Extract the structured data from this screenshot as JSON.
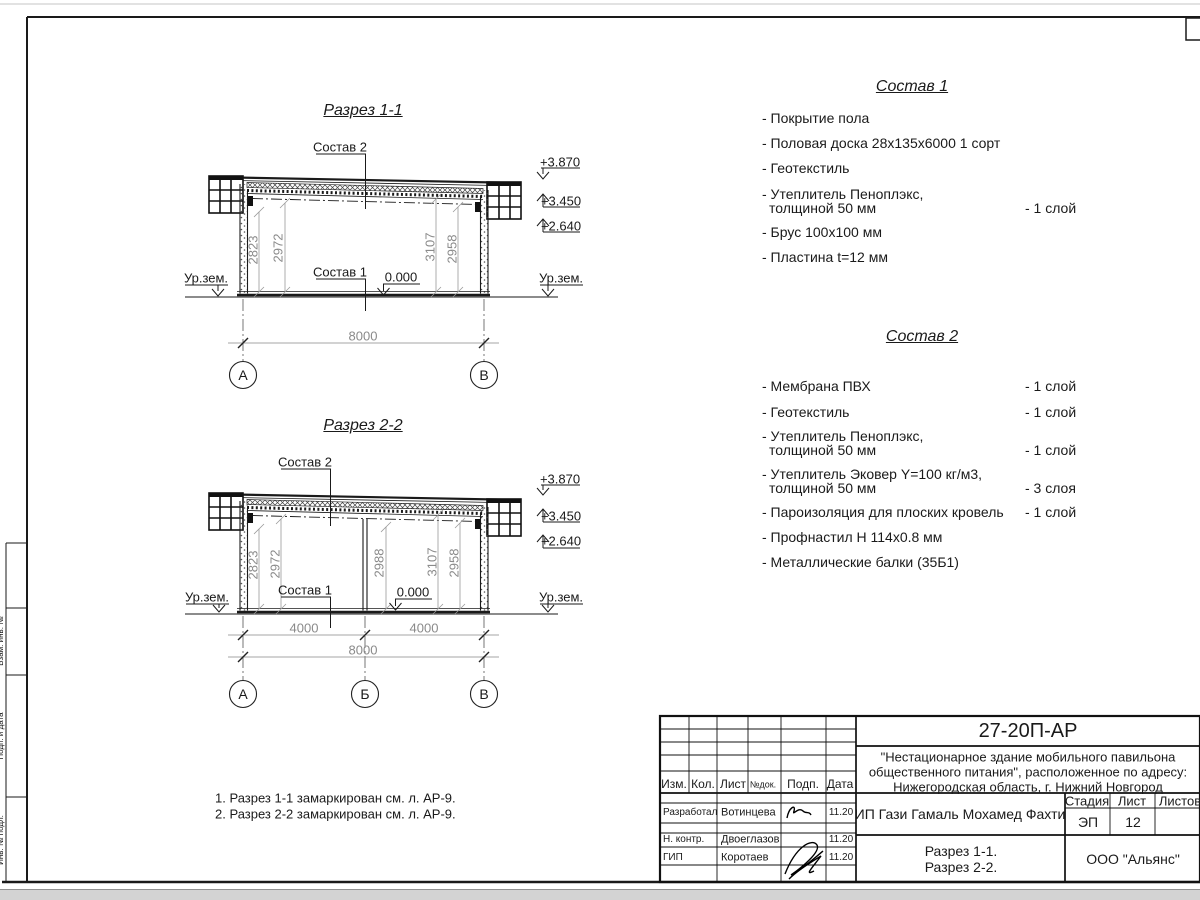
{
  "drawing": {
    "s1": {
      "title": "Разрез 1-1",
      "sostav2_label": "Состав 2",
      "sostav1_label": "Состав 1",
      "zero_mark": "0.000",
      "ground_left": "Ур.зем.",
      "ground_right": "Ур.зем.",
      "elev": [
        "+3.870",
        "+3.450",
        "+2.640"
      ],
      "dims": [
        "2823",
        "2972",
        "3107",
        "2958"
      ],
      "total": "8000",
      "axes": [
        "А",
        "В"
      ]
    },
    "s2": {
      "title": "Разрез 2-2",
      "sostav2_label": "Состав 2",
      "sostav1_label": "Состав 1",
      "zero_mark": "0.000",
      "ground_left": "Ур.зем.",
      "ground_right": "Ур.зем.",
      "elev": [
        "+3.870",
        "+3.450",
        "+2.640"
      ],
      "dims": [
        "2823",
        "2972",
        "2988",
        "3107",
        "2958"
      ],
      "spans": [
        "4000",
        "4000"
      ],
      "total": "8000",
      "axes": [
        "А",
        "Б",
        "В"
      ]
    }
  },
  "sostav1": {
    "title": "Состав 1",
    "lines": [
      {
        "t": "- Покрытие пола",
        "q": ""
      },
      {
        "t": "- Половая доска 28х135х6000 1 сорт",
        "q": ""
      },
      {
        "t": "- Геотекстиль",
        "q": ""
      },
      {
        "t": "- Утеплитель Пеноплэкс,",
        "q": ""
      },
      {
        "t": "толщиной 50 мм",
        "q": "- 1 слой"
      },
      {
        "t": "- Брус 100х100 мм",
        "q": ""
      },
      {
        "t": "- Пластина t=12 мм",
        "q": ""
      }
    ]
  },
  "sostav2": {
    "title": "Состав 2",
    "lines": [
      {
        "t": "- Мембрана ПВХ",
        "q": "- 1 слой"
      },
      {
        "t": "- Геотекстиль",
        "q": "- 1 слой"
      },
      {
        "t": "- Утеплитель Пеноплэкс,",
        "q": ""
      },
      {
        "t": "толщиной 50 мм",
        "q": "- 1 слой"
      },
      {
        "t": "- Утеплитель Эковер Y=100 кг/м3,",
        "q": ""
      },
      {
        "t": "толщиной 50 мм",
        "q": "- 3 слоя"
      },
      {
        "t": "- Пароизоляция для плоских кровель",
        "q": "- 1 слой"
      },
      {
        "t": "- Профнастил Н 114х0.8 мм",
        "q": ""
      },
      {
        "t": "- Металлические балки (35Б1)",
        "q": ""
      }
    ]
  },
  "notes": [
    "1. Разрез 1-1 замаркирован см. л. АР-9.",
    "2. Разрез 2-2 замаркирован см. л. АР-9."
  ],
  "side_strip": [
    "Взам. инв. №",
    "Подп. и дата",
    "Инв. № подл."
  ],
  "titleblock": {
    "doc_code": "27-20П-АР",
    "project_line1": "\"Нестационарное здание мобильного павильона",
    "project_line2": "общественного питания\", расположенное по адресу:",
    "project_line3": "Нижегородская область, г. Нижний Новгород",
    "client": "ИП Гази Гамаль Мохамед Фахти",
    "sheet_title_line1": "Разрез 1-1.",
    "sheet_title_line2": "Разрез 2-2.",
    "company": "ООО \"Альянс\"",
    "headers": {
      "izm": "Изм.",
      "kol": "Кол.",
      "list": "Лист",
      "ndok": "№док.",
      "podp": "Подп.",
      "data": "Дата",
      "stage": "Стадия",
      "sheet": "Лист",
      "sheets": "Листов"
    },
    "stage_value": "ЭП",
    "sheet_value": "12",
    "rows": [
      {
        "role": "Разработал",
        "name": "Вотинцева",
        "date": "11.20"
      },
      {
        "role": "Н. контр.",
        "name": "Двоеглазов",
        "date": "11.20"
      },
      {
        "role": "ГИП",
        "name": "Коротаев",
        "date": "11.20"
      }
    ]
  }
}
